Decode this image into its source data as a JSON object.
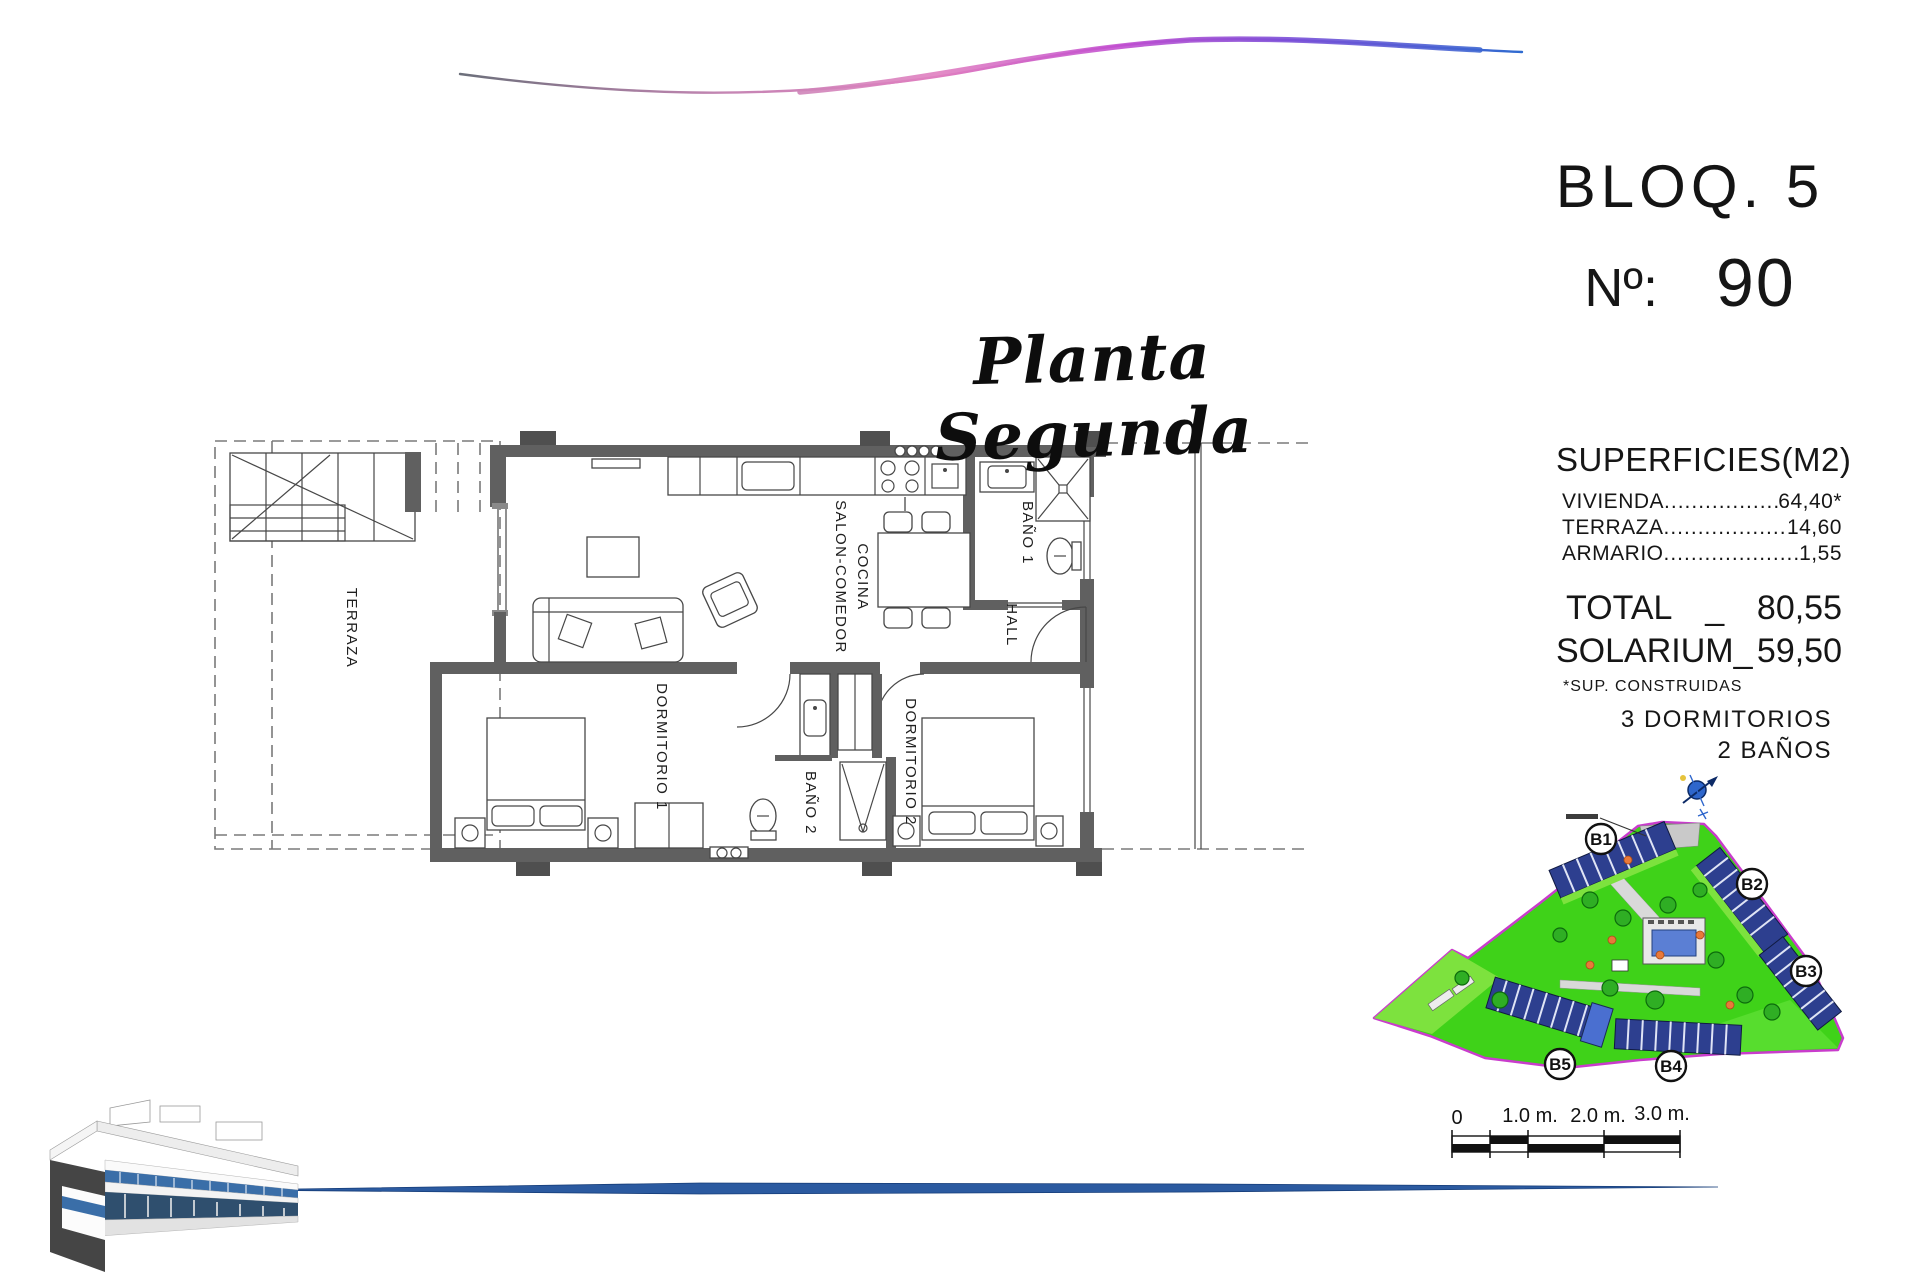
{
  "header": {
    "bloq": "BLOQ. 5",
    "numero_label": "Nº:",
    "numero_value": "90"
  },
  "plan_title": "Planta Segunda",
  "surfaces": {
    "title": "SUPERFICIES(M2)",
    "items": [
      {
        "label": "VIVIENDA",
        "leader": "........................................",
        "value": "64,40*"
      },
      {
        "label": "TERRAZA",
        "leader": "........................................",
        "value": "14,60"
      },
      {
        "label": "ARMARIO",
        "leader": "........................................",
        "value": "1,55"
      }
    ],
    "total_label": "TOTAL",
    "total_sep": "_",
    "total_value": "80,55",
    "solarium_label": "SOLARIUM_",
    "solarium_value": "59,50",
    "footnote": "*SUP. CONSTRUIDAS",
    "features": [
      "3 DORMITORIOS",
      "2 BAÑOS"
    ]
  },
  "floorplan": {
    "rooms": {
      "terraza": "TERRAZA",
      "salon_line1": "SALON-COMEDOR",
      "salon_line2": "COCINA",
      "bano1": "BAÑO 1",
      "hall": "HALL",
      "dorm1": "DORMITORIO 1",
      "bano2": "BAÑO 2",
      "dorm2": "DORMITORIO 2"
    }
  },
  "siteplan": {
    "blocks": [
      "B1",
      "B2",
      "B3",
      "B4",
      "B5"
    ]
  },
  "scalebar": {
    "labels": [
      "0",
      "1.0 m.",
      "2.0 m.",
      "3.0 m."
    ]
  },
  "colors": {
    "wave_blue": "#2f6bd0",
    "wave_magenta": "#c24fd0",
    "wave_pink": "#e07fc0",
    "site_green": "#3fd219",
    "site_border": "#c93ccc",
    "building_navy": "#2d3f8f",
    "pool_blue": "#5b7fd4",
    "wall_gray": "#606060",
    "line_blue": "#2b5aa0"
  }
}
